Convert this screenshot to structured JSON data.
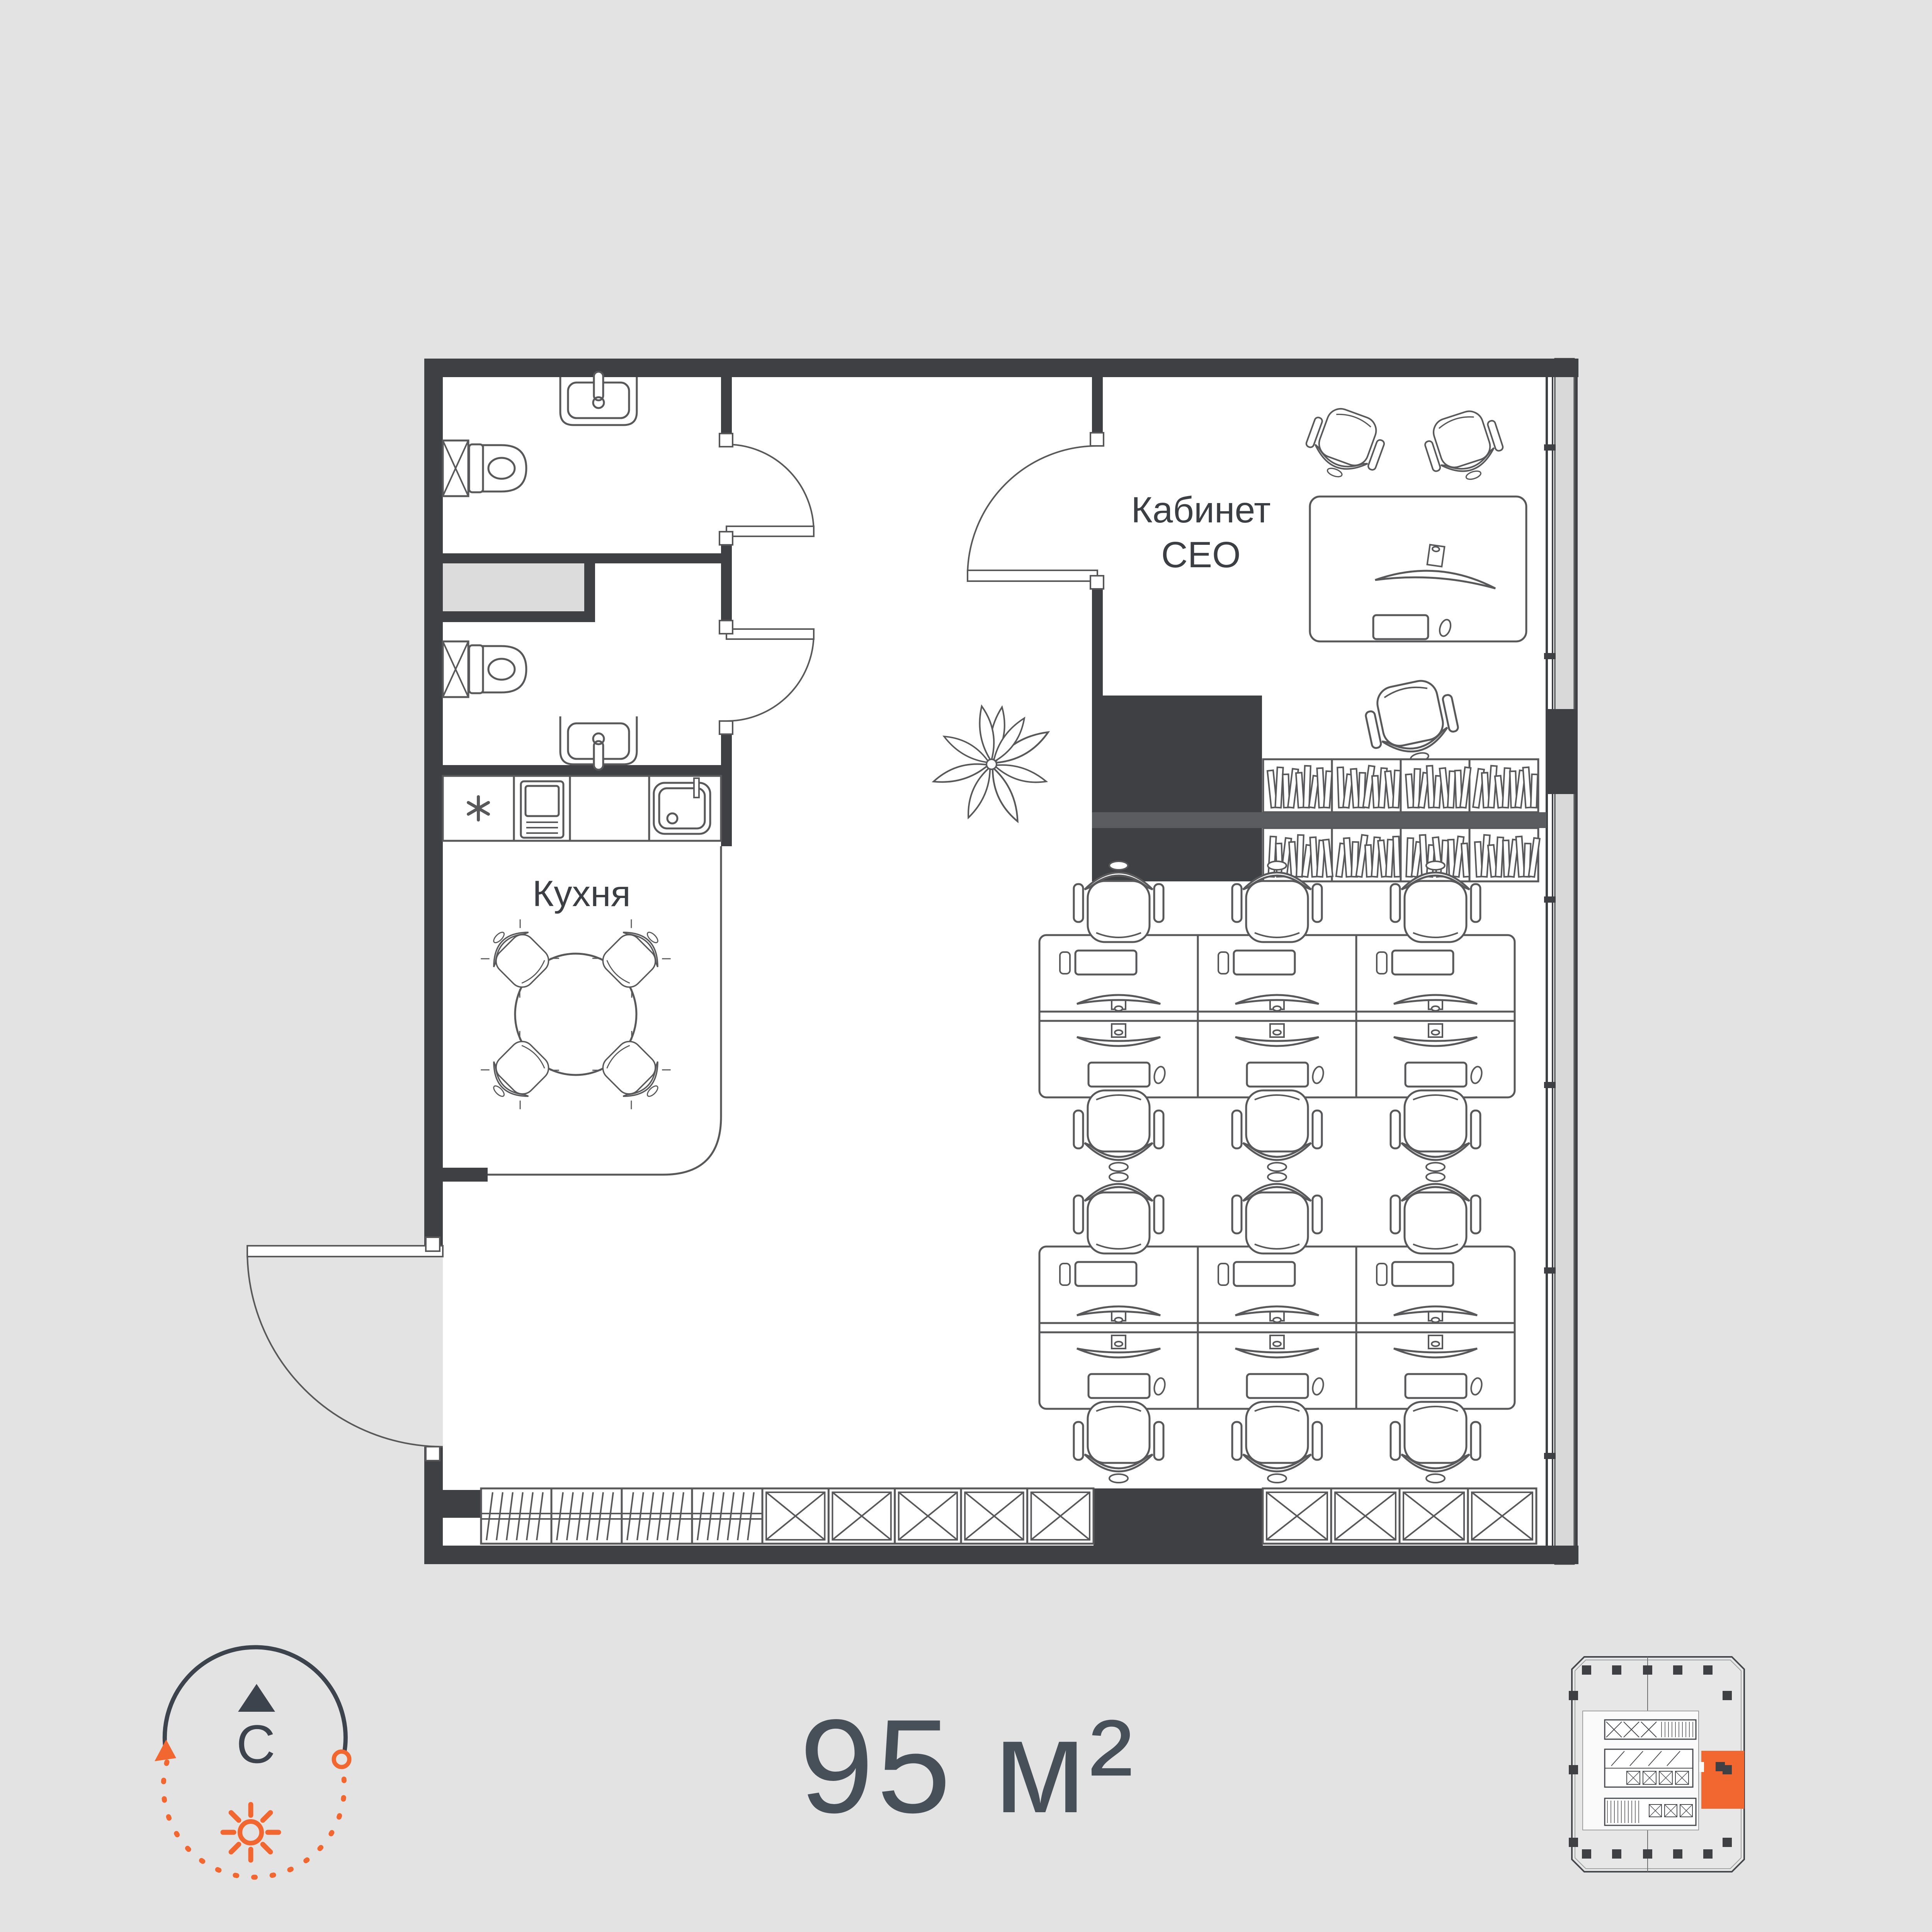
{
  "page": {
    "background": "#e3e3e3",
    "kind": "office-floor-plan"
  },
  "labels": {
    "ceo_office_line1": "Кабинет",
    "ceo_office_line2": "СЕО",
    "kitchen": "Кухня",
    "area": "95 м²",
    "compass_north": "С"
  },
  "colors": {
    "walls": "#3e4043",
    "furniture_outline": "#58585b",
    "accent_orange": "#f2662f",
    "label_text": "#3b3e42",
    "area_text": "#475059",
    "compass_dark": "#3d434c",
    "window_glass_gray": "#d9d9d9",
    "shaft_gray": "#dcdcdc"
  },
  "icons": [
    "north-arrow-icon",
    "sun-icon",
    "toilet-icon",
    "wash-basin-icon",
    "ventilation-shaft-icon",
    "cooktop-icon",
    "oven-icon",
    "kitchen-sink-icon",
    "dining-table-icon",
    "dining-chair-icon",
    "office-chair-icon",
    "monitor-icon",
    "keyboard-icon",
    "mouse-icon",
    "bookshelf-icon",
    "wardrobe-icon",
    "storage-cabinet-icon",
    "plant-icon",
    "door-swing-icon",
    "window",
    "building-keyplan",
    "unit-highlight"
  ]
}
